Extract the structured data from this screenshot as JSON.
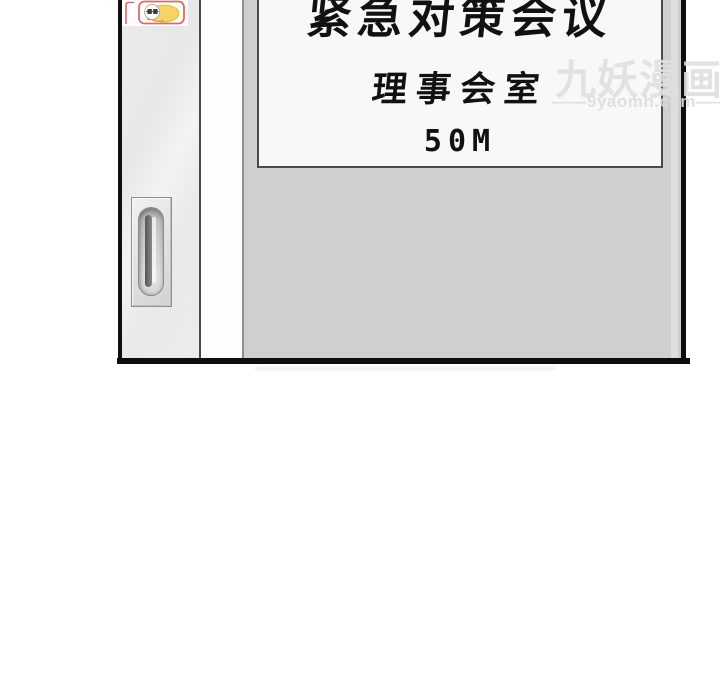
{
  "sign": {
    "title": "紧急对策会议",
    "room": "理事会室",
    "distance": "50M"
  },
  "watermark": {
    "brand": "九妖漫画",
    "site": "——9yaomh.com——"
  },
  "icons": {
    "mascot": "mascot-logo-icon",
    "door_handle": "door-handle"
  },
  "colors": {
    "wall": "#cfcfcf",
    "door": "#ebebeb",
    "sign_background": "#f8f8f8",
    "sign_border": "#4a4a4a",
    "frame_line": "#0d0d0d",
    "watermark_gray": "#dfdfdf",
    "sticker_border": "#d96a6a",
    "mascot_yellow": "#f4d469"
  }
}
